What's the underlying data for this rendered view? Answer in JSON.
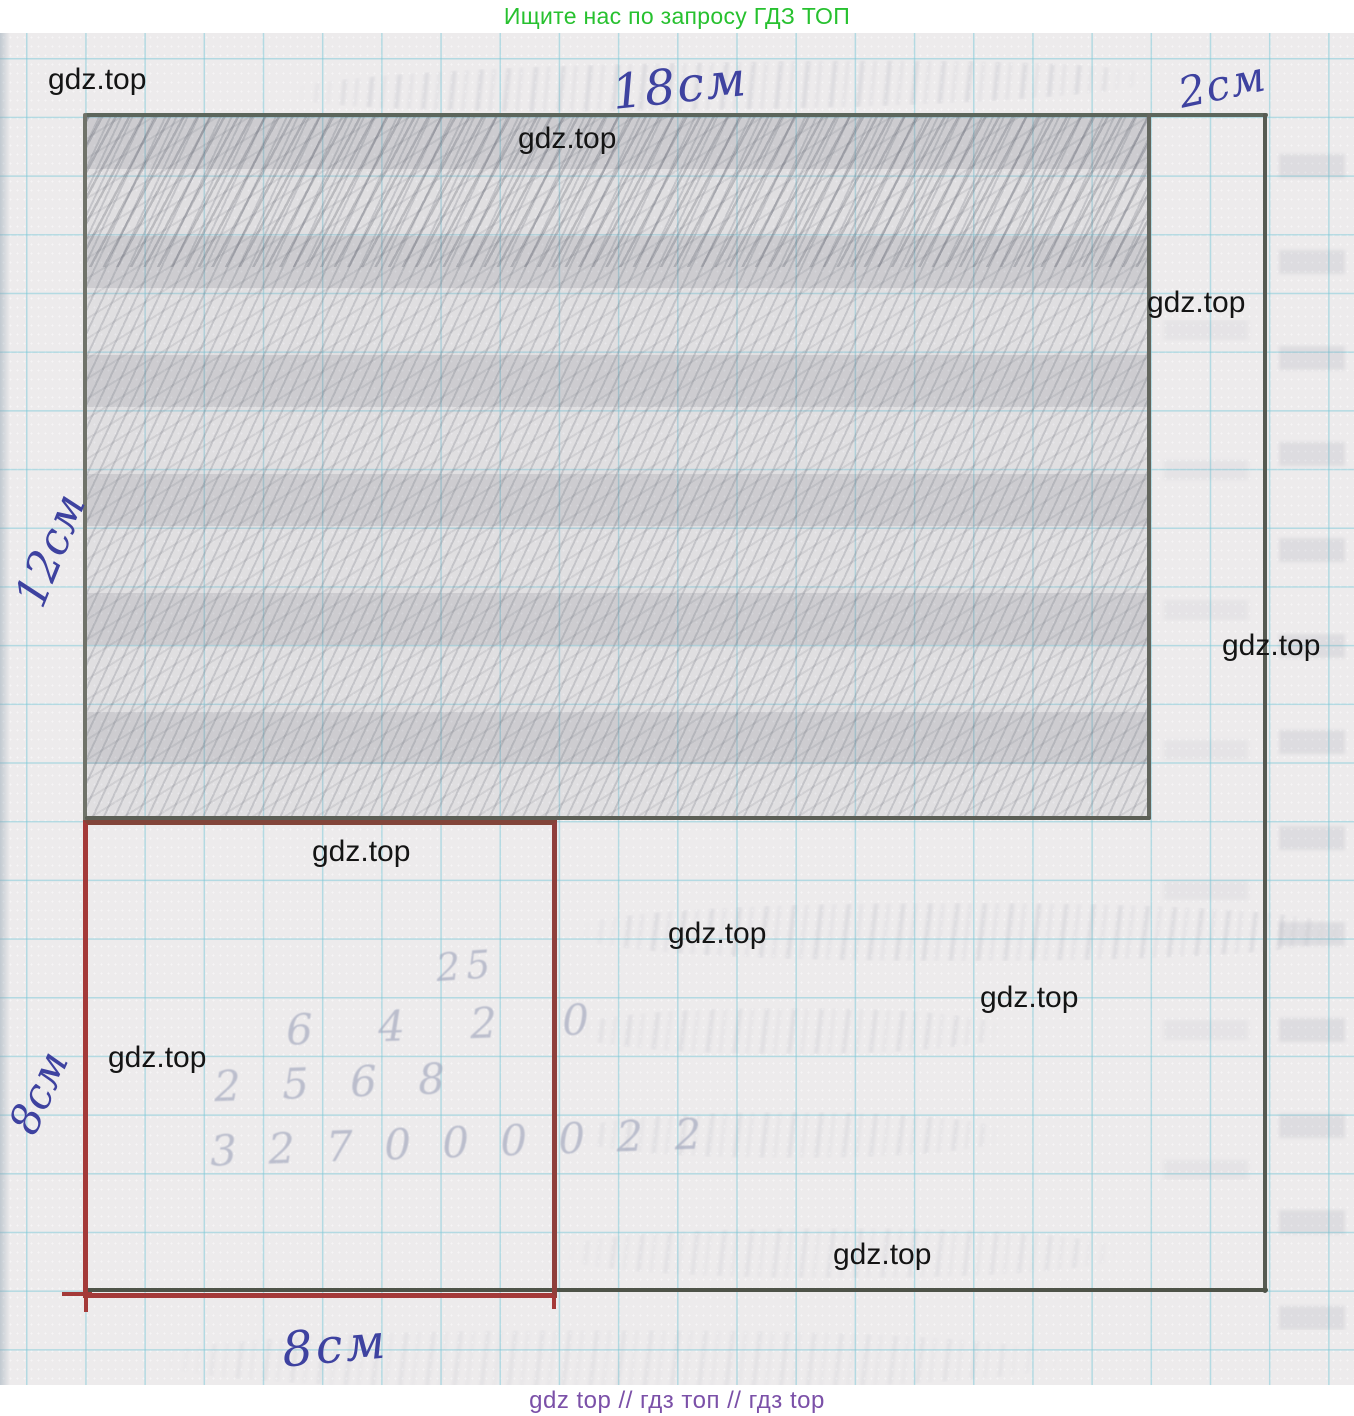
{
  "header": {
    "text": "Ищите нас по запросу ГДЗ ТОП",
    "color": "#27c12f"
  },
  "footer": {
    "text": "gdz top  //  гдз топ  //  гдз top",
    "color": "#7b50a8"
  },
  "figure": {
    "labels": {
      "top_width": "18см",
      "right_strip_width": "2см",
      "left_height": "12см",
      "square_side_left": "8см",
      "square_side_bottom": "8см"
    },
    "colors": {
      "ink_blue": "#3e42a0",
      "pencil_gray": "#5c665c",
      "red_square": "#a43a39",
      "grid_blue": "#7ac8d7",
      "paper": "#edebec"
    }
  },
  "watermarks": [
    {
      "text": "gdz.top"
    },
    {
      "text": "gdz.top"
    },
    {
      "text": "gdz.top"
    },
    {
      "text": "gdz.top"
    },
    {
      "text": "gdz.top"
    },
    {
      "text": "gdz.top"
    },
    {
      "text": "gdz.top"
    },
    {
      "text": "gdz.top"
    },
    {
      "text": "gdz.top"
    }
  ],
  "ghost_numbers": [
    {
      "text": "25"
    },
    {
      "text": "6 4 2 0"
    },
    {
      "text": "2 5 6 8"
    },
    {
      "text": "3 2 7 0 0 0 0 2 2"
    }
  ]
}
